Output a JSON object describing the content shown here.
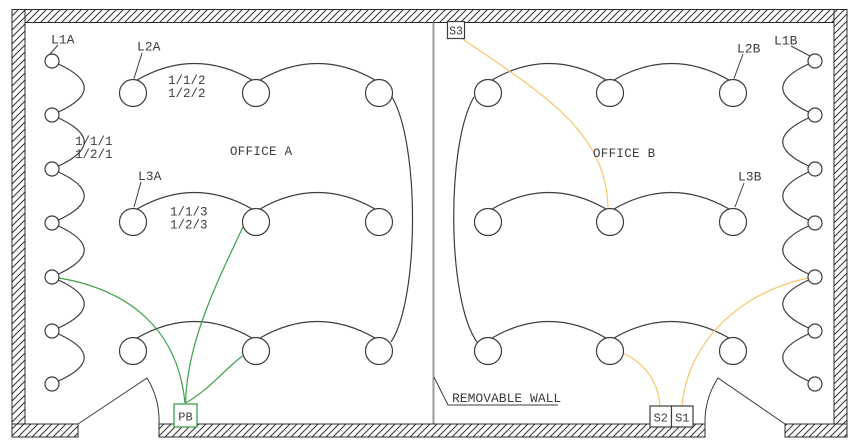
{
  "drawing": {
    "type": "lighting-floor-plan",
    "rooms": {
      "office_a": "OFFICE A",
      "office_b": "OFFICE B"
    },
    "removable_wall_label": "REMOVABLE WALL",
    "luminaire_groups": {
      "l1a": "L1A",
      "l2a": "L2A",
      "l3a": "L3A",
      "l1b": "L1B",
      "l2b": "L2B",
      "l3b": "L3B"
    },
    "circuits": {
      "group1": {
        "line1": "1/1/1",
        "line2": "1/2/1"
      },
      "group2": {
        "line1": "1/1/2",
        "line2": "1/2/2"
      },
      "group3": {
        "line1": "1/1/3",
        "line2": "1/2/3"
      }
    },
    "switches": {
      "pb": "PB",
      "s1": "S1",
      "s2": "S2",
      "s3": "S3"
    },
    "colors": {
      "circuit_green": "#3CA04A",
      "circuit_orange": "#FBC568",
      "line": "#3C3C3C",
      "removable_wall_gray": "#9A9A9A"
    }
  }
}
